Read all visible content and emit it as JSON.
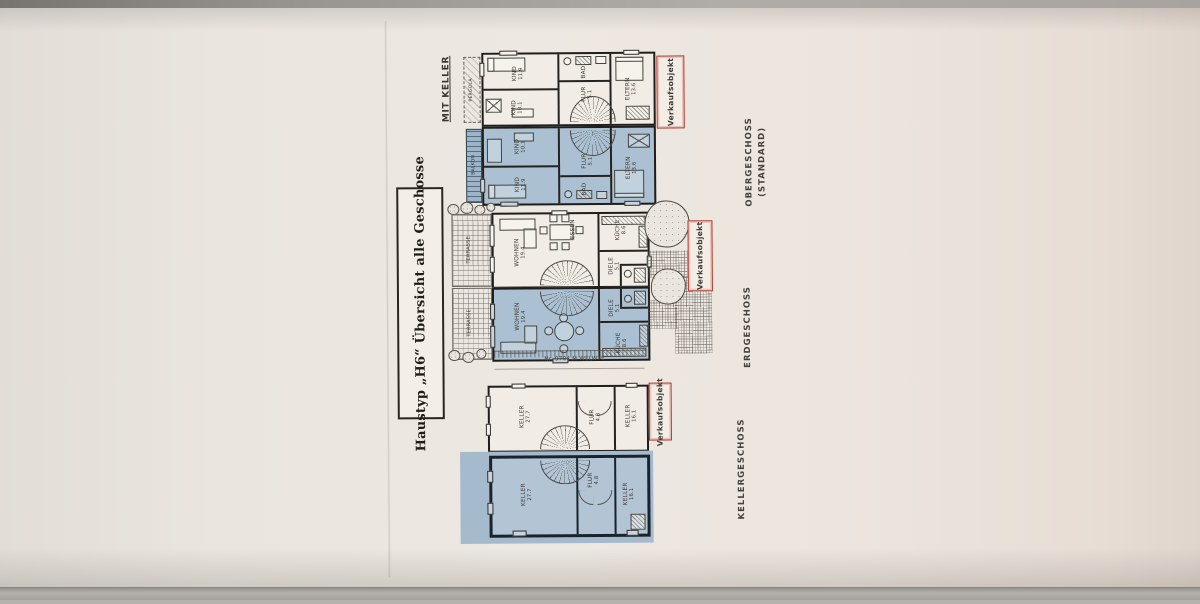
{
  "document": {
    "title": "Haustyp „H6“ Übersicht alle Geschosse",
    "keller_note": "MIT KELLER",
    "sale_tag": "Verkaufsobjekt",
    "eg_caption": "Nr. 9704 M WELWTE"
  },
  "floors": {
    "og": {
      "label": "OBERGESCHOSS",
      "sublabel": "(STANDARD)"
    },
    "eg": {
      "label": "ERDGESCHOSS"
    },
    "kg": {
      "label": "KELLERGESCHOSS"
    }
  },
  "rooms": {
    "kind1": {
      "name": "KIND",
      "area": "11.9"
    },
    "kind2": {
      "name": "KIND",
      "area": "10.1"
    },
    "eltern": {
      "name": "ELTERN",
      "area": "13.6"
    },
    "bad": {
      "name": "BAD",
      "area": ""
    },
    "flur_og": {
      "name": "FLUR",
      "area": "5.1"
    },
    "balkon": {
      "name": "BALKON",
      "area": ""
    },
    "pergola": {
      "name": "PERGOLA",
      "area": ""
    },
    "wohnen": {
      "name": "WOHNEN",
      "area": "19.4"
    },
    "essen": {
      "name": "ESSEN",
      "area": ""
    },
    "kueche": {
      "name": "KÜCHE",
      "area": "8.6"
    },
    "diele": {
      "name": "DIELE",
      "area": "5.1"
    },
    "terrasse": {
      "name": "TERRASSE",
      "area": ""
    },
    "keller_gross": {
      "name": "KELLER",
      "area": "27.7"
    },
    "flur_kg": {
      "name": "FLUR",
      "area": "4.8"
    },
    "keller_klein": {
      "name": "KELLER",
      "area": "16.1"
    }
  },
  "colors": {
    "sold_unit_fill": "#abc0d2",
    "sale_tag_border": "#b23a30",
    "paper": "#ece5de"
  }
}
